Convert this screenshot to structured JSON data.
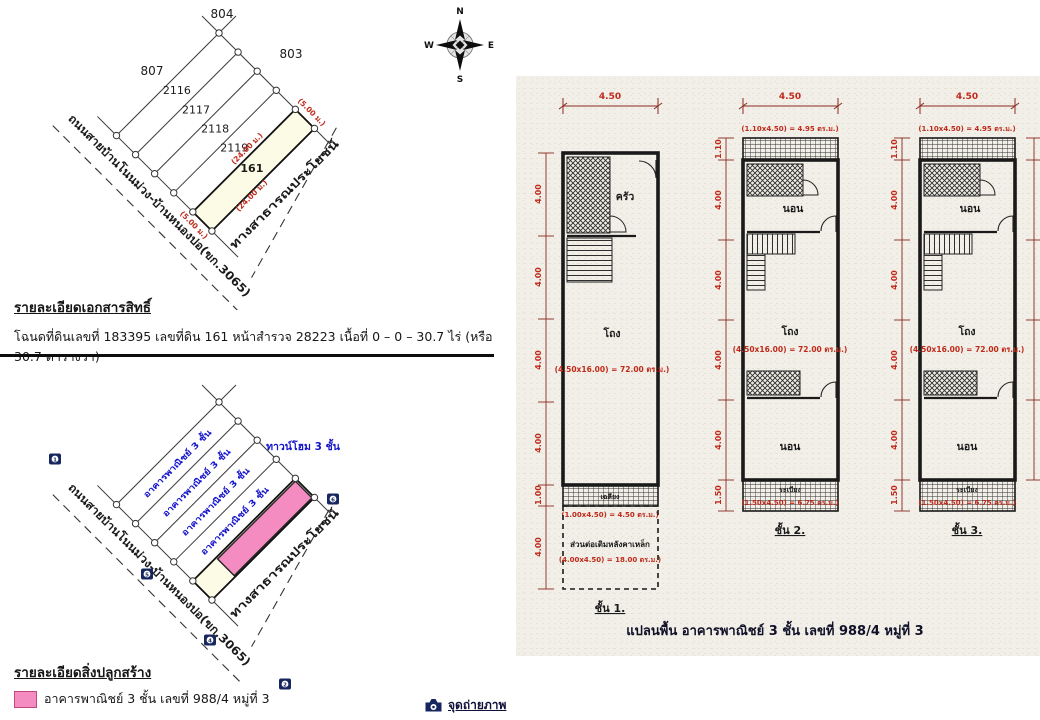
{
  "colors": {
    "pink": "#f58cc1",
    "cream": "#fcfce6",
    "red": "#c02a1c",
    "blue": "#1414cc",
    "navy": "#16265e"
  },
  "compass": {
    "n": "N",
    "s": "S",
    "e": "E",
    "w": "W"
  },
  "deed_map": {
    "parcel_top": "804",
    "parcel_right": "803",
    "parcel_left_outer": "807",
    "strips": [
      "2116",
      "2117",
      "2118",
      "2119"
    ],
    "subject": "161",
    "dim_long_left": "(24.00 ม.)",
    "dim_long_right": "(24.00 ม.)",
    "dim_short_top": "(5.00 ม.)",
    "dim_short_bottom": "(5.00 ม.)",
    "road_main": "ถนนสายบ้านโนนม่วง-บ้านหนองปอ(ขก.3065)",
    "road_side": "ทางสาธารณประโยชน์"
  },
  "deed_details": {
    "heading": "รายละเอียดเอกสารสิทธิ์",
    "body": "โฉนดที่ดินเลขที่ 183395 เลขที่ดิน 161 หน้าสำรวจ 28223 เนื้อที่ 0 – 0 – 30.7 ไร่ (หรือ 30.7 ตารางวา)"
  },
  "building_map": {
    "strip_labels": [
      "อาคารพาณิชย์ 3 ชั้น",
      "อาคารพาณิชย์ 3 ชั้น",
      "อาคารพาณิชย์ 3 ชั้น",
      "อาคารพาณิชย์ 3 ชั้น"
    ],
    "townhome_label": "ทาวน์โฮม 3 ชั้น",
    "road_main": "ถนนสายบ้านโนนม่วง-บ้านหนองปอ(ขก.3065)",
    "road_side": "ทางสาธารณประโยชน์",
    "camera_points": [
      "1",
      "5",
      "4",
      "2",
      "6"
    ]
  },
  "legend": {
    "heading": "รายละเอียดสิ่งปลูกสร้าง",
    "item_label": "อาคารพาณิชย์ 3 ชั้น เลขที่ 988/4 หมู่ที่ 3"
  },
  "photo_note": {
    "label": "จุดถ่ายภาพ"
  },
  "floor_plans": {
    "caption": "แปลนพื้น อาคารพาณิชย์ 3 ชั้น เลขที่ 988/4 หมู่ที่ 3",
    "top_width": "4.50",
    "plans": [
      {
        "label": "ชั้น 1.",
        "dims": [
          "4.00",
          "4.00",
          "4.00",
          "4.00",
          "1.00",
          "4.00"
        ],
        "room_top": "ครัว",
        "hall": "โถง",
        "hall_area": "(4.50x16.00) = 72.00 ตร.ม.)",
        "strip_label": "เฉลียง",
        "strip_area": "(1.00x4.50) = 4.50 ตร.ม.)",
        "ext_label": "ส่วนต่อเติมหลังคาเหล็ก",
        "ext_area": "(4.00x4.50) = 18.00 ตร.ม.)"
      },
      {
        "label": "ชั้น 2.",
        "top_area": "(1.10x4.50) = 4.95 ตร.ม.)",
        "dims": [
          "1.10",
          "4.00",
          "4.00",
          "4.00",
          "4.00",
          "1.50"
        ],
        "room_top": "นอน",
        "hall": "โถง",
        "hall_area": "(4.50x16.00) = 72.00 ตร.ม.)",
        "room_bottom": "นอน",
        "strip_label": "ระเบียง",
        "strip_area": "(1.50x4.50) = 6.75 ตร.ม.)"
      },
      {
        "label": "ชั้น 3.",
        "top_area": "(1.10x4.50) = 4.95 ตร.ม.)",
        "dims": [
          "1.10",
          "4.00",
          "4.00",
          "4.00",
          "4.00",
          "1.50"
        ],
        "room_top": "นอน",
        "hall": "โถง",
        "hall_area": "(4.50x16.00) = 72.00 ตร.ม.)",
        "room_bottom": "นอน",
        "strip_label": "ระเบียง",
        "strip_area": "(1.50x4.50) = 6.75 ตร.ม.)"
      }
    ]
  }
}
